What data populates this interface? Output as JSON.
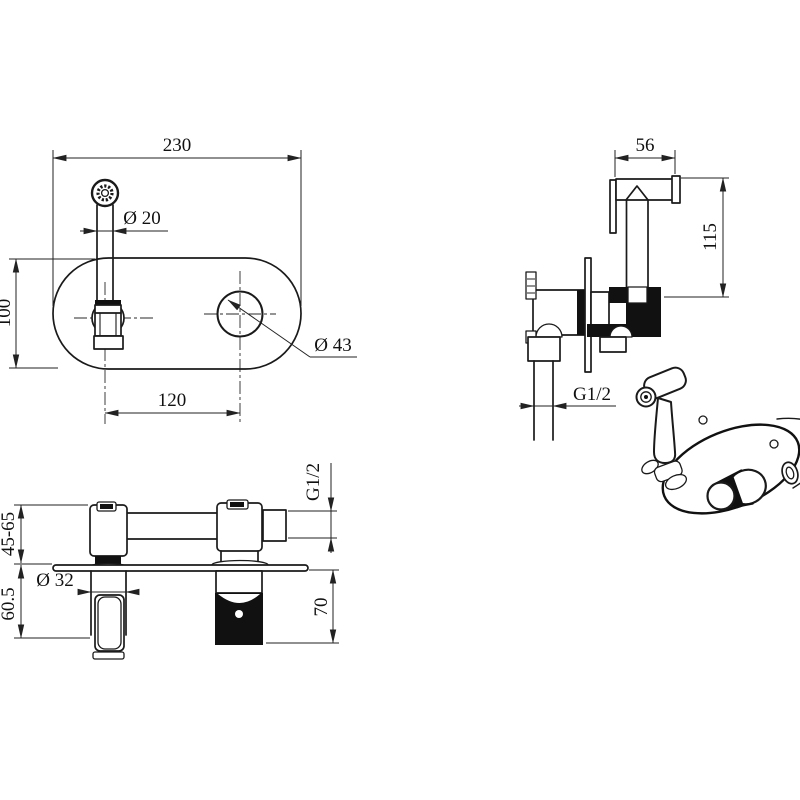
{
  "views": {
    "plan": {
      "width": "230",
      "spout_dia": "Ø 20",
      "height": "100",
      "hole_dia": "Ø 43",
      "spacing": "120"
    },
    "side": {
      "head_width": "56",
      "height": "115",
      "thread": "G1/2"
    },
    "front": {
      "depth_range": "45-65",
      "below_plate": "60.5",
      "shaft_dia": "Ø 32",
      "valve_depth": "70",
      "thread": "G1/2"
    }
  },
  "colors": {
    "line": "#1a1a1a",
    "background": "#ffffff"
  }
}
